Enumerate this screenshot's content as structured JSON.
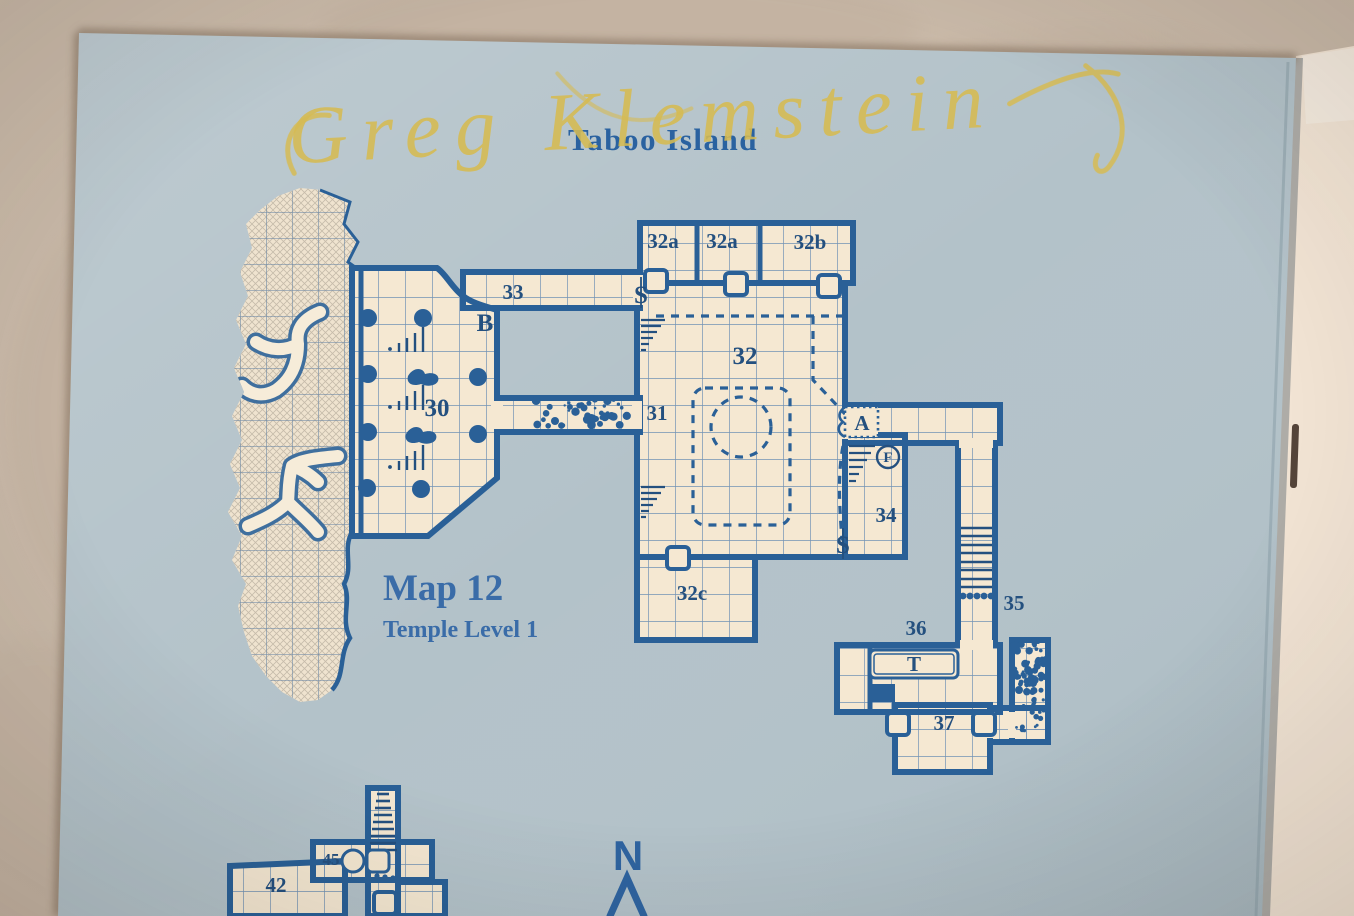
{
  "page": {
    "title": "Taboo Island"
  },
  "annotations": {
    "handwriting": "Greg Klemstein",
    "ink_color": "#d6bb52"
  },
  "caption": {
    "title": "Map 12",
    "subtitle": "Temple Level 1"
  },
  "map": {
    "compass": "N",
    "labels": {
      "r32a1": "32a",
      "r32a2": "32a",
      "r32b": "32b",
      "r33": "33",
      "door_b": "B",
      "r30": "30",
      "r31": "31",
      "r32": "32",
      "door_a": "A",
      "mark_f": "F",
      "r34": "34",
      "secret_s1": "S",
      "secret_s2": "S",
      "r32c": "32c",
      "r35": "35",
      "r36": "36",
      "mark_t": "T",
      "r37": "37",
      "r45": "45",
      "r42": "42"
    },
    "colors": {
      "table_tan": "#c9b9a8",
      "paper_blue": "#b3c2c9",
      "room_cream": "#f5e8d2",
      "wall_blue": "#2a6097",
      "label_navy": "#24507f",
      "title_blue": "#2a62a0",
      "booklet_page": "#f2e4d4"
    }
  }
}
